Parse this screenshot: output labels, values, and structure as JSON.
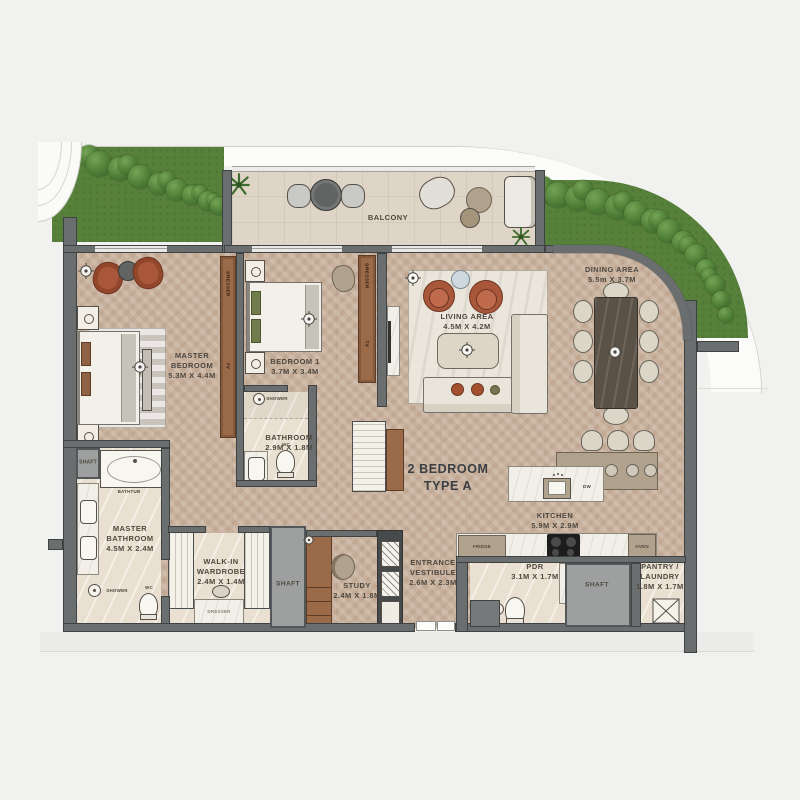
{
  "plan": {
    "unit_label": "2 BEDROOM\nTYPE A",
    "rooms": {
      "balcony": "BALCONY",
      "master_bedroom": "MASTER\nBEDROOM\n5.3M X 4.4M",
      "bedroom_1": "BEDROOM 1\n3.7M X 3.4M",
      "bathroom": "BATHROOM\n2.9M X 1.8M",
      "living": "LIVING AREA\n4.5M X 4.2M",
      "dining": "DINING AREA\n5.5m X 3.7M",
      "master_bathroom": "MASTER\nBATHROOM\n4.5M X 2.4M",
      "wardrobe": "WALK-IN\nWARDROBE\n2.4M X 1.4M",
      "study": "STUDY\n2.4M X 1.8M",
      "vestibule": "ENTRANCE\nVESTIBULE\n2.6M X 2.3M",
      "kitchen": "KITCHEN\n5.9M X 2.9M",
      "pdr": "PDR\n3.1M X 1.7M",
      "pantry": "PANTRY /\nLAUNDRY\n1.8M X 1.7M",
      "shaft": "SHAFT"
    },
    "fixtures": {
      "fridge": "FRIDGE",
      "oven": "OVEN",
      "dw": "DW",
      "dresser": "DRESSER",
      "tv": "TV",
      "bathtub": "BATHTUB",
      "shower": "SHOWER",
      "wc": "WC"
    },
    "colors": {
      "wall": "#6b6e6e",
      "wood_floor": "#c8b19d",
      "balcony_tile": "#ded5c6",
      "cream_floor": "#e9e0d1",
      "lawn": "#57813b",
      "hedge": "#4e7d36",
      "rug": "#ebe6dc",
      "terracotta": "#a8573b",
      "wood_furniture": "#9b6a49",
      "counter_taupe": "#b0a28c",
      "dining_table": "#5a5147",
      "label_text": "#4e483f"
    }
  }
}
